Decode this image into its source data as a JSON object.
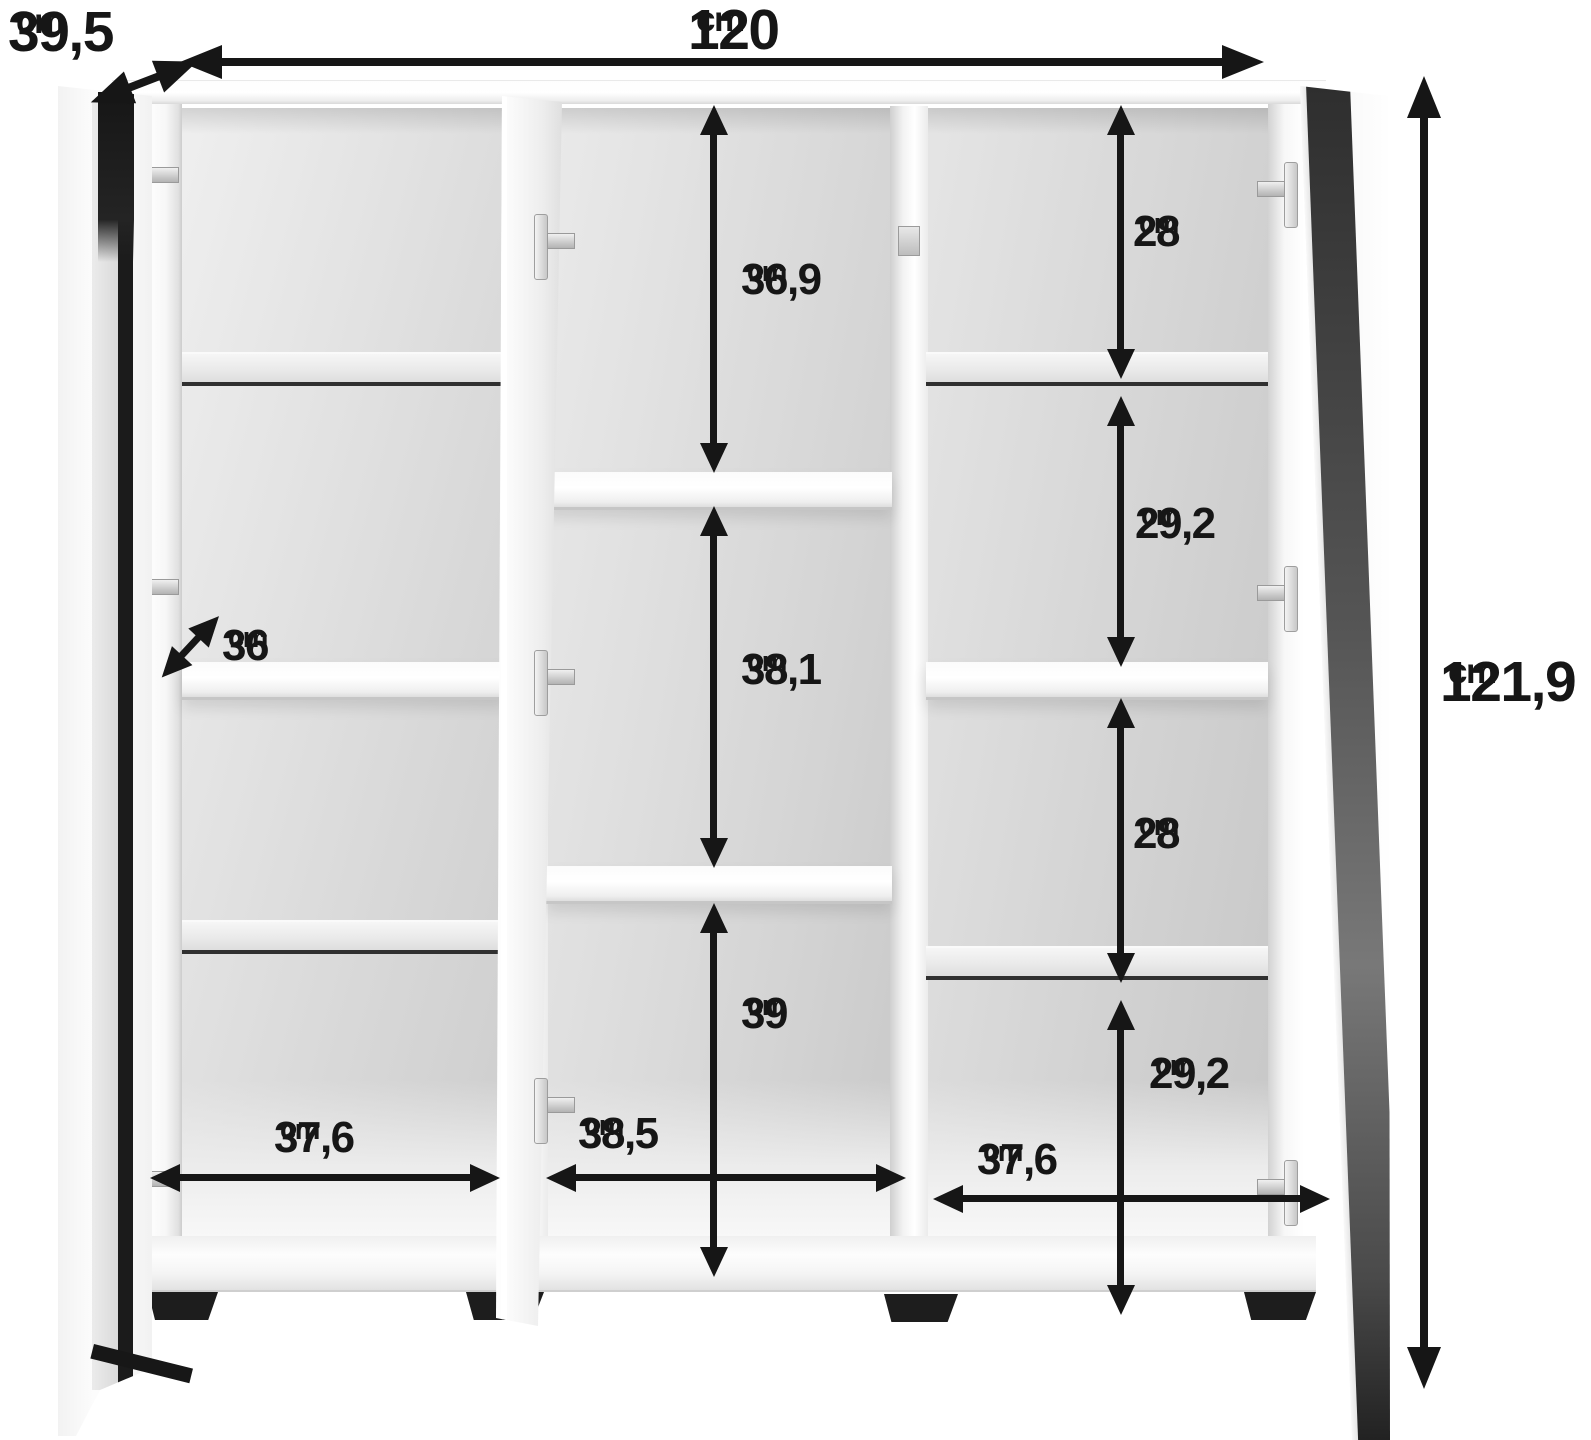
{
  "title": "cabinet-dimensions-diagram",
  "unit_default": "cm",
  "colors": {
    "ink": "#161616",
    "bg": "#ffffff",
    "foot": "#1d1d1d"
  },
  "dims": {
    "depth": {
      "value": "39,5",
      "unit": "cm"
    },
    "width": {
      "value": "120",
      "unit": "cm"
    },
    "height": {
      "value": "121,9",
      "unit": "cm"
    },
    "left": {
      "shelf_depth": {
        "value": "36",
        "unit": "cm"
      },
      "inner_width": {
        "value": "37,6",
        "unit": "cm"
      }
    },
    "middle": {
      "top_compartment_height": {
        "value": "36,9",
        "unit": "cm"
      },
      "middle_compartment_height": {
        "value": "38,1",
        "unit": "cm"
      },
      "bottom_compartment_height": {
        "value": "39",
        "unit": "cm"
      },
      "inner_width": {
        "value": "38,5",
        "unit": "cm"
      }
    },
    "right": {
      "compartment_1_height": {
        "value": "28",
        "unit": "cm"
      },
      "compartment_2_height": {
        "value": "29,2",
        "unit": "cm"
      },
      "compartment_3_height": {
        "value": "28",
        "unit": "cm"
      },
      "compartment_4_height": {
        "value": "29,2",
        "unit": "cm"
      },
      "inner_width": {
        "value": "37,6",
        "unit": "cm"
      }
    }
  }
}
